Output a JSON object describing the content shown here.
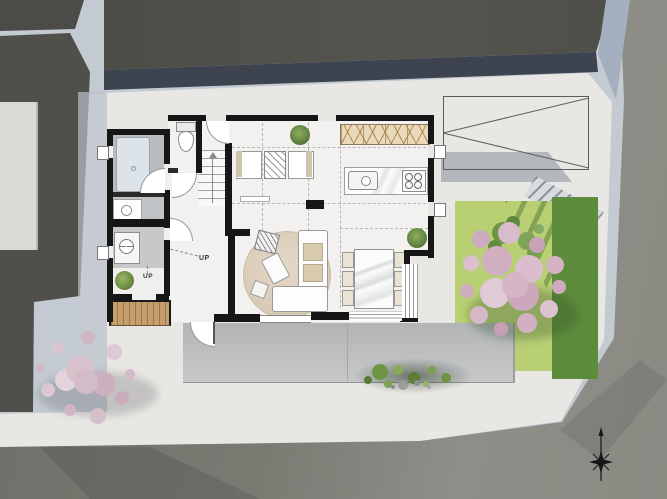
{
  "scene": {
    "title": "Residential ground-floor site plan",
    "type": "top-down architectural floor plan render"
  },
  "labels": {
    "up_main_stair": "UP",
    "up_entry_step": "UP"
  },
  "compass": {
    "type": "north-arrow"
  },
  "palette": {
    "asphalt": "#4b4b47",
    "shadow_strip": "#3d4450",
    "road": "#75756f",
    "pavement": "#8e8e88",
    "path": "#c4cad2",
    "property": "#e9e7e3",
    "floor": "#f2f1ef",
    "wall": "#161616",
    "grass": "#b9cf74",
    "grass_shadow": "#5d8c3c",
    "deck_wood": "#c49e6b",
    "cabinets": "#e8d9bb",
    "rug": "#ded1bf",
    "blossom_pink": "#d6b6c6",
    "foliage_green": "#6d9547"
  }
}
